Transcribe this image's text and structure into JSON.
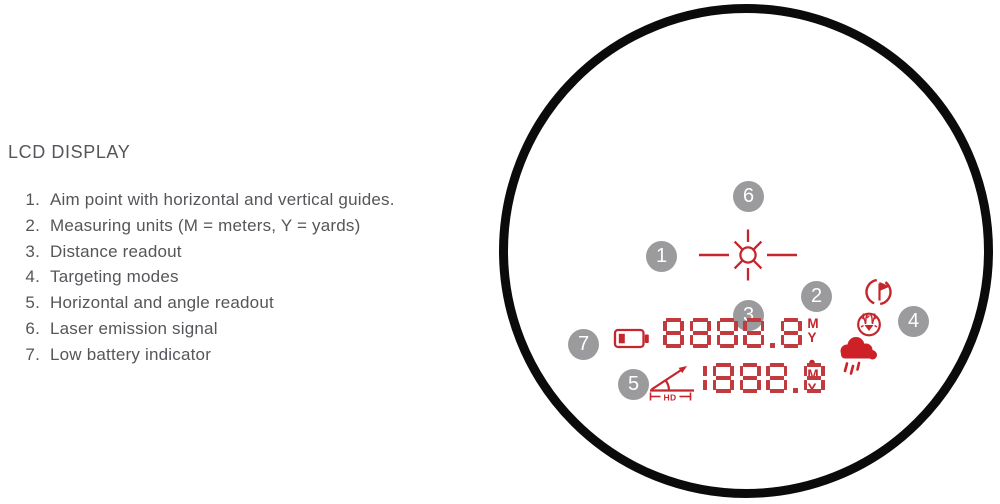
{
  "panel": {
    "title": "LCD DISPLAY",
    "items": [
      {
        "num": "1.",
        "text": "Aim point with horizontal and vertical guides."
      },
      {
        "num": "2.",
        "text": "Measuring units (M = meters, Y = yards)"
      },
      {
        "num": "3.",
        "text": "Distance readout"
      },
      {
        "num": "4.",
        "text": "Targeting modes"
      },
      {
        "num": "5.",
        "text": "Horizontal and angle readout"
      },
      {
        "num": "6.",
        "text": "Laser emission signal"
      },
      {
        "num": "7.",
        "text": "Low battery indicator"
      }
    ]
  },
  "display": {
    "distance_readout": "8888.8",
    "angle_readout": "1888.8",
    "units": {
      "primary": [
        "M",
        "Y"
      ],
      "secondary": [
        "M",
        "Y"
      ]
    },
    "hd_label": "HD",
    "callouts": [
      "1",
      "2",
      "3",
      "4",
      "5",
      "6",
      "7"
    ]
  },
  "colors": {
    "lcd_red": "#c5262d",
    "digit_red": "#c13a3e",
    "cloud_red": "#ce2127",
    "callout_gray": "#9b9b9d",
    "text_gray": "#55565a",
    "ring_black": "#0b0b0b"
  }
}
